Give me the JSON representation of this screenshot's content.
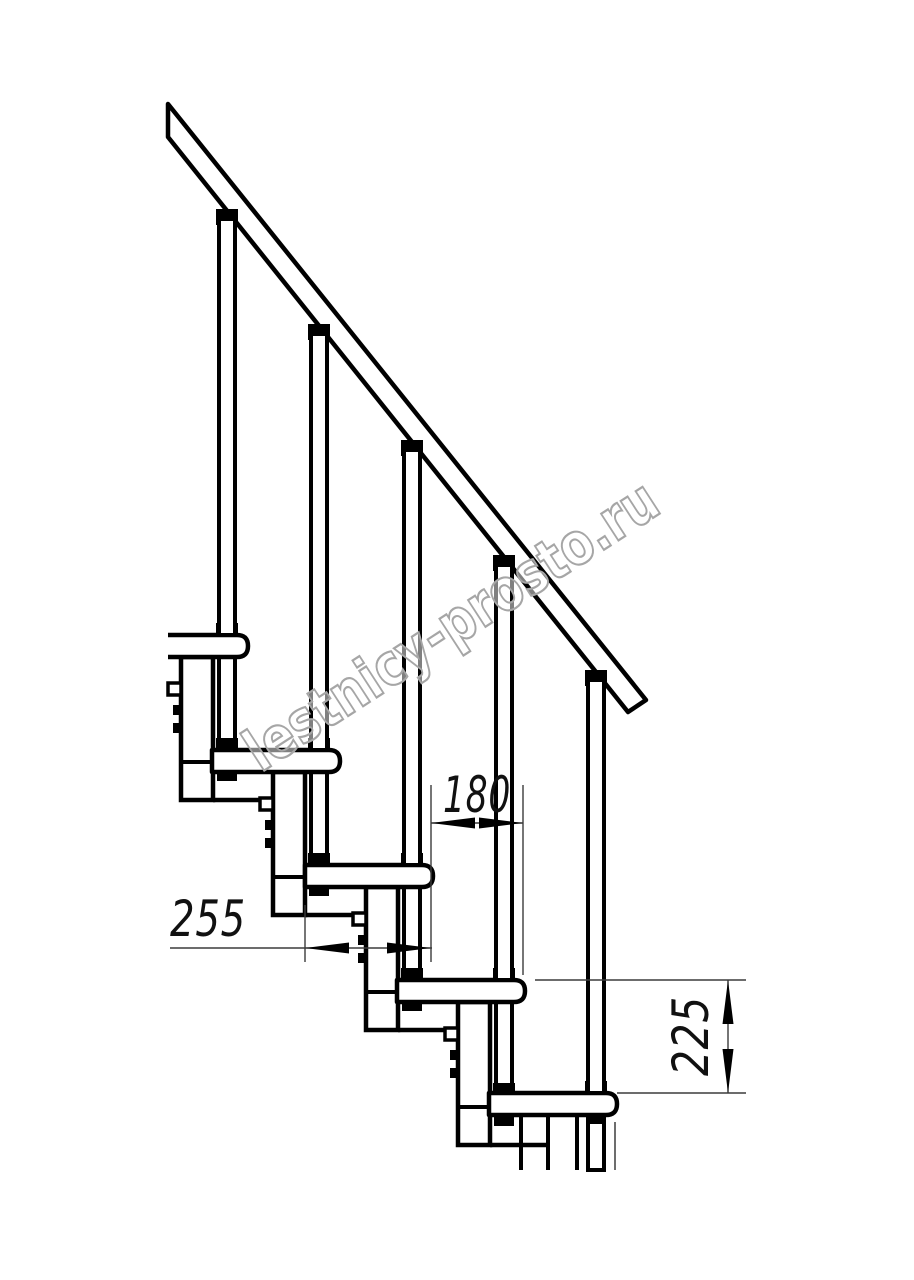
{
  "document": {
    "kind": "staircase-side-view-technical-drawing",
    "background_color": "#ffffff",
    "line_color": "#000000",
    "dim_line_color": "#3c3c3c"
  },
  "dims": {
    "run": {
      "label": "180"
    },
    "depth": {
      "label": "255"
    },
    "rise": {
      "label": "225"
    }
  },
  "watermark": {
    "text": "lestnicy-prosto.ru",
    "color": "#a6a6a6"
  },
  "stairs": {
    "tread_count": 5,
    "baluster_count": 5,
    "support_box_count": 5,
    "handrail": true
  }
}
